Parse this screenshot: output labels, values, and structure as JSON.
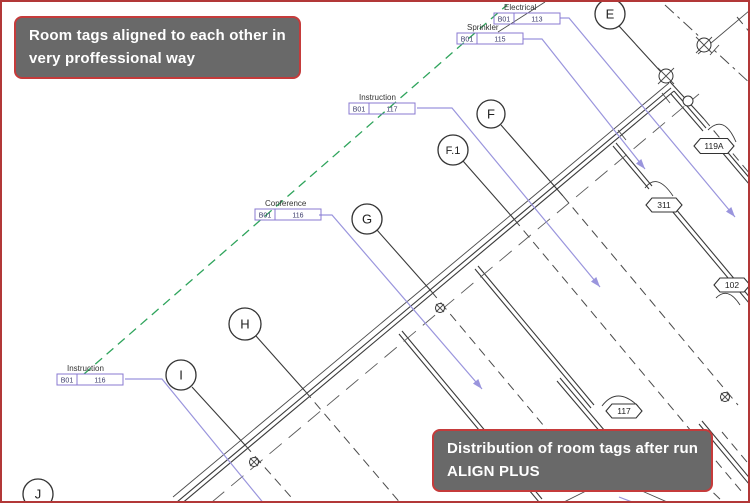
{
  "notes": {
    "top": {
      "line1": "Room tags aligned to each other in",
      "line2": "very proffessional way"
    },
    "bottom": {
      "line1": "Distribution of room tags after run",
      "line2": "ALIGN PLUS"
    }
  },
  "colors": {
    "note_bg": "#696969",
    "note_border": "#c53b3b",
    "note_text": "#ffffff",
    "frame_border": "#b23838",
    "wall": "#3a3a3a",
    "leader": "#9a95dd",
    "align_line": "#2fa45c",
    "tag_box_border": "#8878d0",
    "canvas_bg": "#ffffff"
  },
  "grid_bubbles": [
    {
      "id": "E",
      "label": "E",
      "cx": 608,
      "cy": 12,
      "r": 15,
      "fs": 13
    },
    {
      "id": "F",
      "label": "F",
      "cx": 489,
      "cy": 112,
      "r": 14,
      "fs": 13
    },
    {
      "id": "F1",
      "label": "F.1",
      "cx": 451,
      "cy": 148,
      "r": 15,
      "fs": 11
    },
    {
      "id": "G",
      "label": "G",
      "cx": 365,
      "cy": 217,
      "r": 15,
      "fs": 13
    },
    {
      "id": "H",
      "label": "H",
      "cx": 243,
      "cy": 322,
      "r": 16,
      "fs": 13
    },
    {
      "id": "I",
      "label": "I",
      "cx": 179,
      "cy": 373,
      "r": 15,
      "fs": 13
    },
    {
      "id": "J",
      "label": "J",
      "cx": 36,
      "cy": 492,
      "r": 15,
      "fs": 13
    }
  ],
  "room_tags": [
    {
      "id": "electrical",
      "label": "Electrical",
      "level": "B01",
      "number": "113",
      "bx": 492,
      "by": 11
    },
    {
      "id": "sprinkler",
      "label": "Sprinkler",
      "level": "B01",
      "number": "115",
      "bx": 455,
      "by": 31
    },
    {
      "id": "instruction-top",
      "label": "Instruction",
      "level": "B01",
      "number": "117",
      "bx": 347,
      "by": 101
    },
    {
      "id": "conference",
      "label": "Conference",
      "level": "B01",
      "number": "116",
      "bx": 253,
      "by": 207
    },
    {
      "id": "instruction-bottom",
      "label": "Instruction",
      "level": "B01",
      "number": "116",
      "bx": 55,
      "by": 372
    }
  ],
  "door_tags": [
    {
      "id": "119A",
      "label": "119A",
      "cx": 712,
      "cy": 144,
      "w": 40,
      "h": 15
    },
    {
      "id": "311",
      "label": "311",
      "cx": 662,
      "cy": 203,
      "w": 36,
      "h": 14
    },
    {
      "id": "102",
      "label": "102",
      "cx": 730,
      "cy": 283,
      "w": 36,
      "h": 14
    },
    {
      "id": "117",
      "label": "117",
      "cx": 622,
      "cy": 409,
      "w": 36,
      "h": 14
    }
  ]
}
